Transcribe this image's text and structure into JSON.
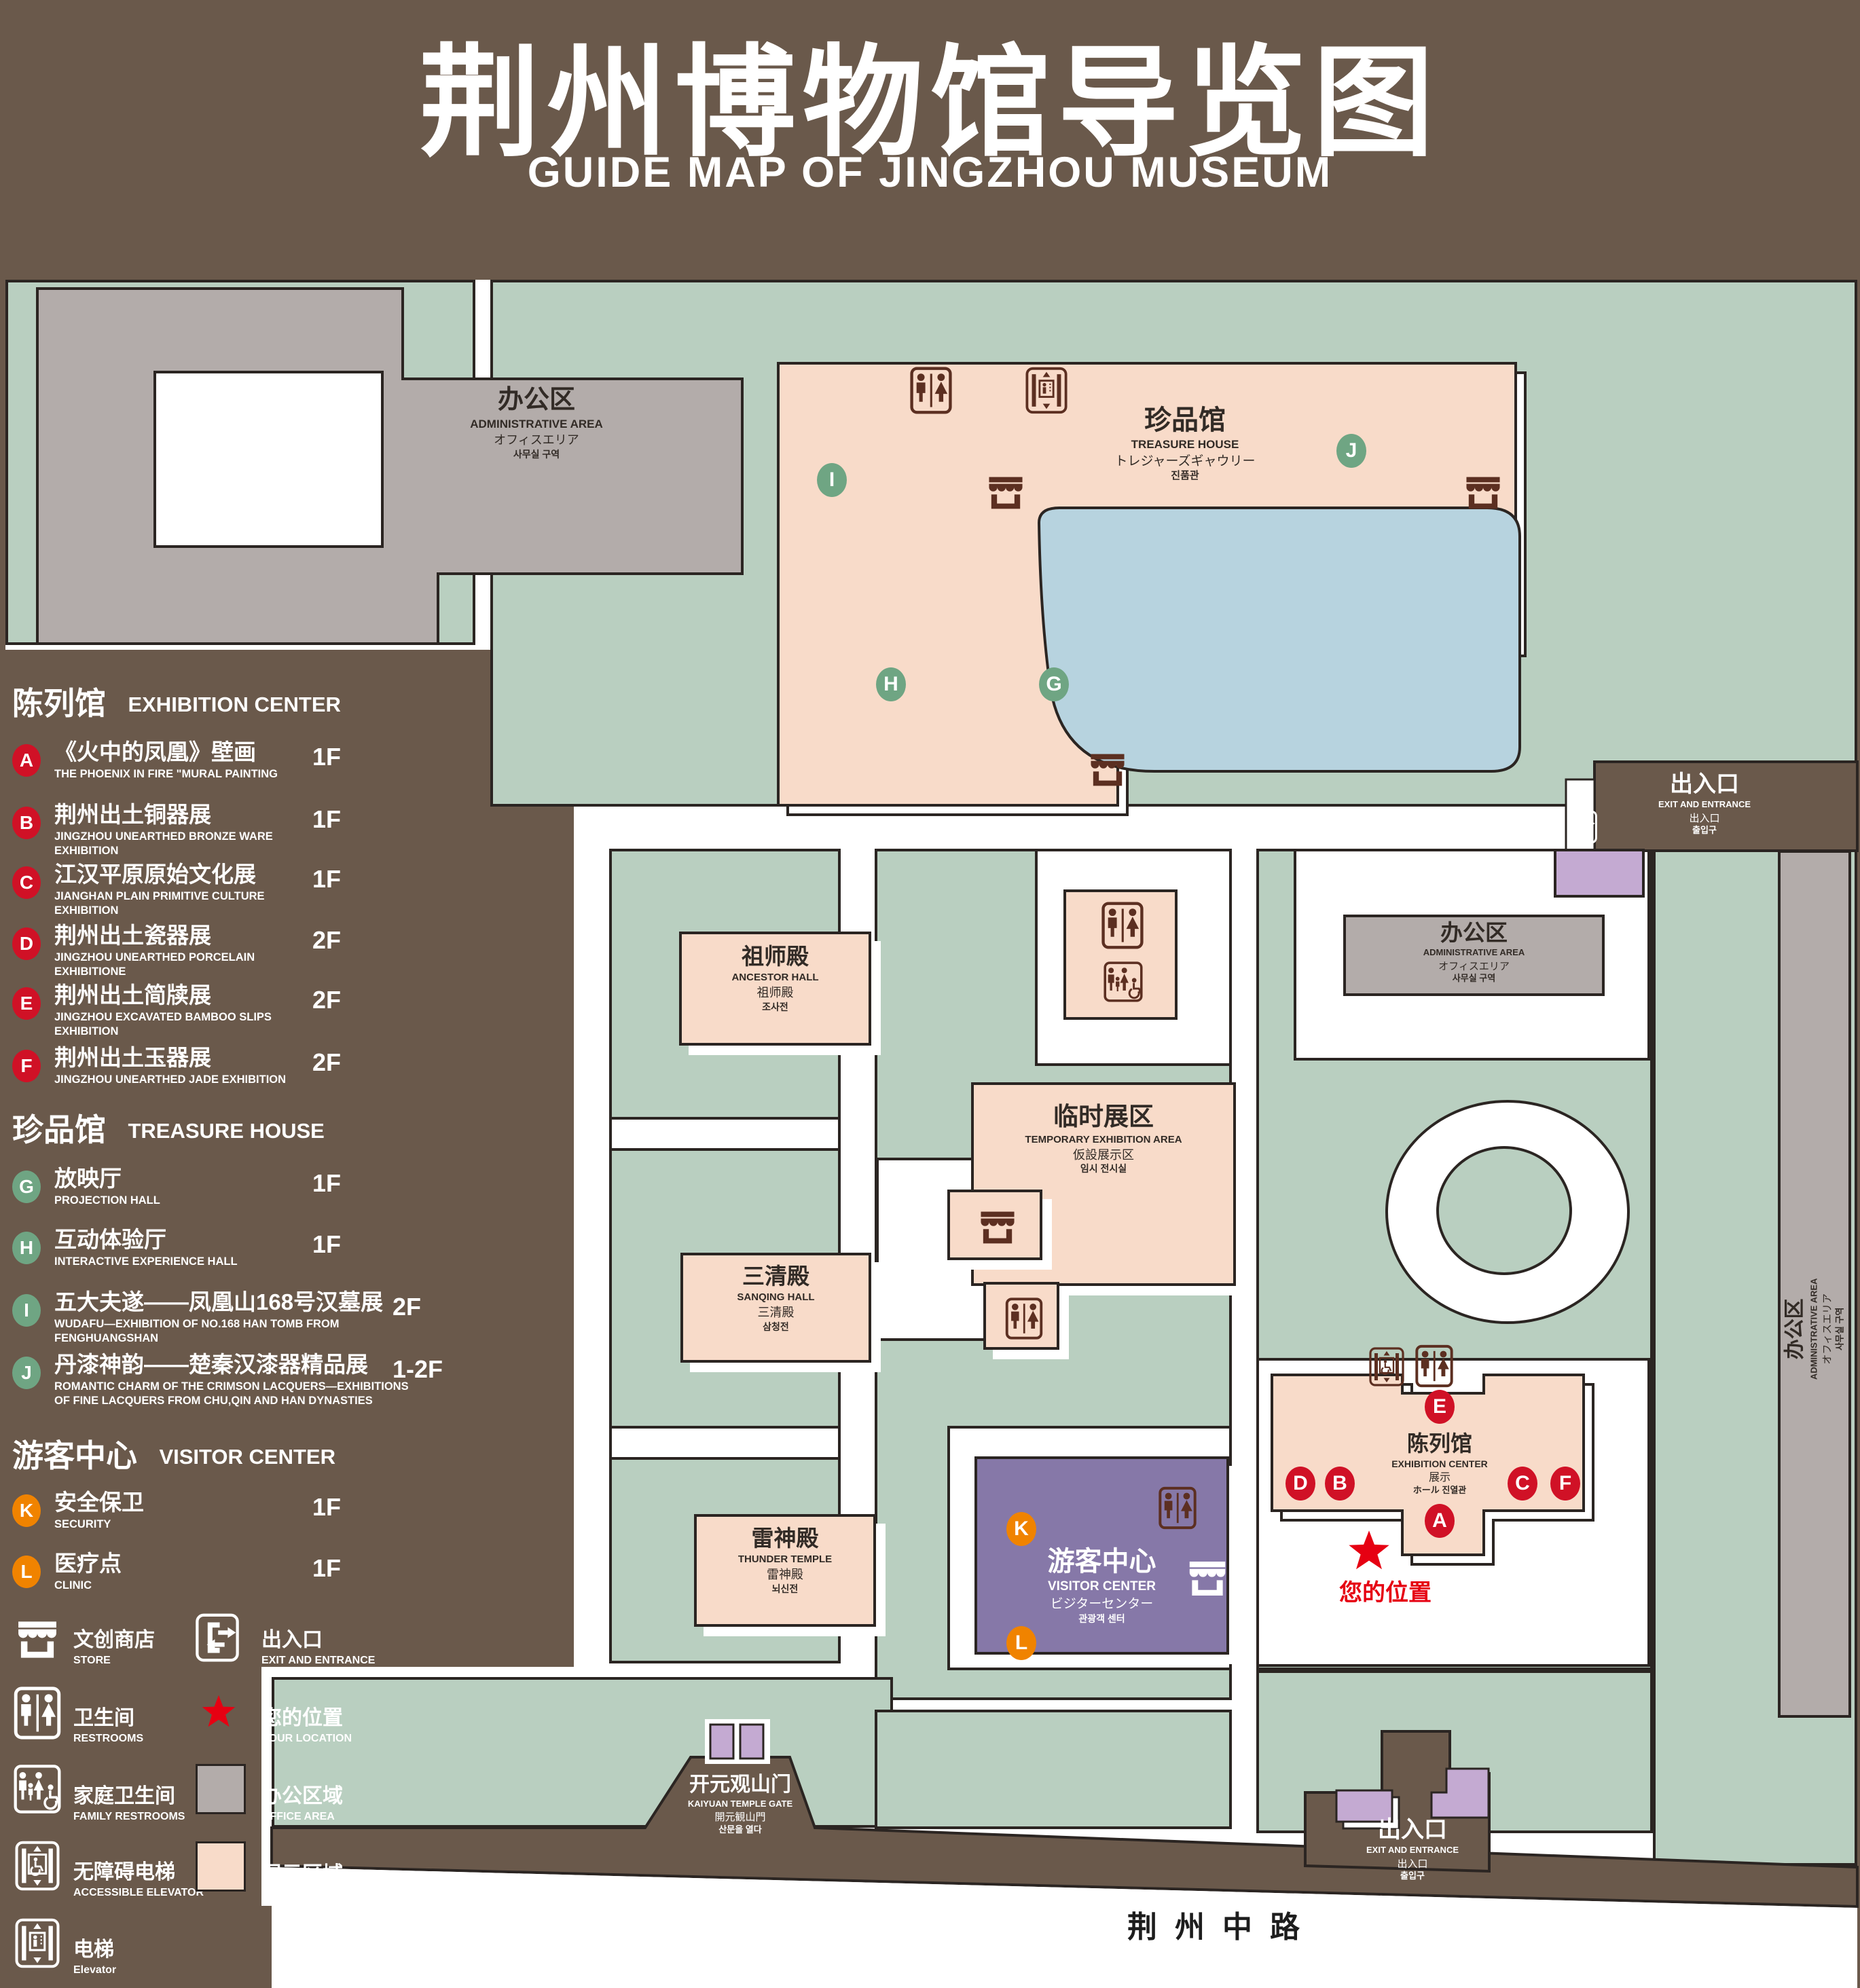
{
  "title": {
    "cn": "荆州博物馆导览图",
    "en": "GUIDE MAP OF JINGZHOU MUSEUM"
  },
  "colors": {
    "background": "#6a594b",
    "lawn_green": "#b9cfc0",
    "path_white": "#ffffff",
    "display_pink": "#f8dbc9",
    "office_gray": "#b3acaa",
    "visitor_purple": "#8678a8",
    "gate_purple": "#c4aad2",
    "pond_blue": "#b7d3df",
    "outline_dark": "#2b2522",
    "badge_red": "#d01126",
    "badge_green": "#6fa583",
    "badge_orange": "#f08300",
    "star_red": "#e60012",
    "icon_brown": "#5c2f21"
  },
  "legend": {
    "sections": [
      {
        "title_cn": "陈列馆",
        "title_en": "EXHIBITION CENTER",
        "items": [
          {
            "letter": "A",
            "cn": "《火中的凤凰》壁画",
            "en": "THE PHOENIX IN FIRE \"MURAL PAINTING",
            "floor": "1F"
          },
          {
            "letter": "B",
            "cn": "荆州出土铜器展",
            "en": "JINGZHOU UNEARTHED BRONZE WARE EXHIBITION",
            "floor": "1F"
          },
          {
            "letter": "C",
            "cn": "江汉平原原始文化展",
            "en": "JIANGHAN PLAIN PRIMITIVE CULTURE EXHIBITION",
            "floor": "1F"
          },
          {
            "letter": "D",
            "cn": "荆州出土瓷器展",
            "en": "JINGZHOU UNEARTHED PORCELAIN EXHIBITIONE",
            "floor": "2F"
          },
          {
            "letter": "E",
            "cn": "荆州出土简牍展",
            "en": "JINGZHOU EXCAVATED BAMBOO SLIPS EXHIBITION",
            "floor": "2F"
          },
          {
            "letter": "F",
            "cn": "荆州出土玉器展",
            "en": "JINGZHOU UNEARTHED JADE EXHIBITION",
            "floor": "2F"
          }
        ]
      },
      {
        "title_cn": "珍品馆",
        "title_en": "TREASURE HOUSE",
        "items": [
          {
            "letter": "G",
            "cn": "放映厅",
            "en": "PROJECTION HALL",
            "floor": "1F"
          },
          {
            "letter": "H",
            "cn": "互动体验厅",
            "en": "INTERACTIVE EXPERIENCE HALL",
            "floor": "1F"
          },
          {
            "letter": "I",
            "cn": "五大夫遂——凤凰山168号汉墓展",
            "en": "WUDAFU—EXHIBITION OF NO.168 HAN TOMB FROM FENGHUANGSHAN",
            "floor": "2F"
          },
          {
            "letter": "J",
            "cn": "丹漆神韵——楚秦汉漆器精品展",
            "en": "ROMANTIC CHARM OF THE CRIMSON LACQUERS—EXHIBITIONS OF FINE LACQUERS FROM CHU,QIN AND HAN DYNASTIES",
            "floor": "1-2F"
          }
        ]
      },
      {
        "title_cn": "游客中心",
        "title_en": "VISITOR CENTER",
        "items": [
          {
            "letter": "K",
            "cn": "安全保卫",
            "en": "SECURITY",
            "floor": "1F"
          },
          {
            "letter": "L",
            "cn": "医疗点",
            "en": "CLINIC",
            "floor": "1F"
          }
        ]
      }
    ],
    "symbols": [
      {
        "icon": "store-icon",
        "cn": "文创商店",
        "en": "STORE"
      },
      {
        "icon": "exit-icon",
        "cn": "出入口",
        "en": "EXIT AND ENTRANCE"
      },
      {
        "icon": "restroom-icon",
        "cn": "卫生间",
        "en": "RESTROOMS"
      },
      {
        "icon": "location-star-icon",
        "cn": "您的位置",
        "en": "YOUR LOCATION"
      },
      {
        "icon": "family-restroom-icon",
        "cn": "家庭卫生间",
        "en": "FAMILY RESTROOMS"
      },
      {
        "icon": "office-area-swatch",
        "cn": "办公区域",
        "en": "OFFICE AREA"
      },
      {
        "icon": "accessible-elevator-icon",
        "cn": "无障碍电梯",
        "en": "ACCESSIBLE ELEVATOR"
      },
      {
        "icon": "display-area-swatch",
        "cn": "展示区域",
        "en": "DISPLAY AREA"
      },
      {
        "icon": "elevator-icon",
        "cn": "电梯",
        "en": "Elevator"
      }
    ]
  },
  "map": {
    "buildings": {
      "admin": {
        "cn": "办公区",
        "en": "ADMINISTRATIVE AREA",
        "jp": "オフィスエリア",
        "kr": "사무실 구역"
      },
      "treasure": {
        "cn": "珍品馆",
        "en": "TREASURE HOUSE",
        "jp": "トレジャーズギャウリー",
        "kr": "진품관"
      },
      "ancestor": {
        "cn": "祖师殿",
        "en": "ANCESTOR HALL",
        "jp": "祖师殿",
        "kr": "조사전"
      },
      "temporary": {
        "cn": "临时展区",
        "en": "TEMPORARY EXHIBITION AREA",
        "jp": "仮設展示区",
        "kr": "임시 전시실"
      },
      "sanqing": {
        "cn": "三清殿",
        "en": "SANQING HALL",
        "jp": "三清殿",
        "kr": "삼청전"
      },
      "thunder": {
        "cn": "雷神殿",
        "en": "THUNDER TEMPLE",
        "jp": "雷神殿",
        "kr": "뇌신전"
      },
      "visitor": {
        "cn": "游客中心",
        "en": "VISITOR CENTER",
        "jp": "ビジターセンター",
        "kr": "관광객 센터"
      },
      "exhibition": {
        "cn": "陈列馆",
        "en": "EXHIBITION CENTER",
        "jp": "展示",
        "kr": "ホール 진열관"
      },
      "gate": {
        "cn": "开元观山门",
        "en": "KAIYUAN TEMPLE GATE",
        "jp": "開元観山門",
        "kr": "산문을 열다"
      },
      "exit": {
        "cn": "出入口",
        "en": "EXIT AND ENTRANCE",
        "jp": "出入口",
        "kr": "출입구"
      }
    },
    "badges": {
      "A": "A",
      "B": "B",
      "C": "C",
      "D": "D",
      "E": "E",
      "F": "F",
      "G": "G",
      "H": "H",
      "I": "I",
      "J": "J",
      "K": "K",
      "L": "L"
    },
    "road": "荆州中路",
    "your_location": "您的位置"
  }
}
